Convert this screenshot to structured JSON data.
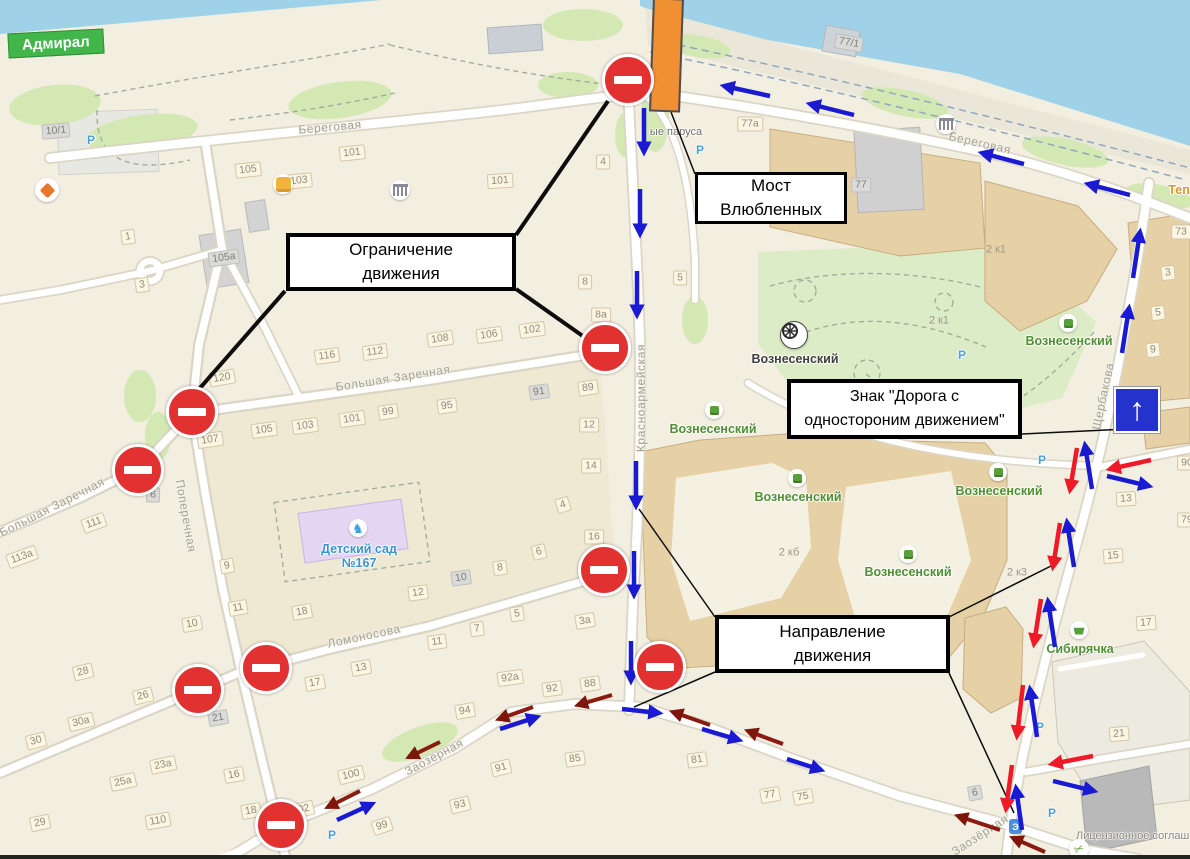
{
  "app": {
    "type": "map-annotation-screenshot"
  },
  "admiral": {
    "label": "Адмирал"
  },
  "license": {
    "text": "Лицензионное соглашение"
  },
  "callouts": {
    "most": {
      "line1": "Мост",
      "line2": "Влюбленных"
    },
    "ogranichenie": {
      "line1": "Ограничение",
      "line2": "движения"
    },
    "znak": {
      "line1": "Знак \"Дорога с",
      "line2": "одностороним движением\""
    },
    "napravlenie": {
      "line1": "Направление",
      "line2": "движения"
    }
  },
  "streets": [
    [
      "Береговая",
      330,
      127,
      -5
    ],
    [
      "Береговая",
      980,
      143,
      13
    ],
    [
      "Красноармейская",
      641,
      398,
      -90
    ],
    [
      "Щербакова",
      1103,
      396,
      -78
    ],
    [
      "Большая Заречная",
      52,
      507,
      -27
    ],
    [
      "Большая Заречная",
      393,
      378,
      -9
    ],
    [
      "Поперечная",
      186,
      516,
      80
    ],
    [
      "Ломоносова",
      364,
      636,
      -12
    ],
    [
      "Заозёрная",
      434,
      757,
      -28
    ],
    [
      "Заозёрная",
      980,
      835,
      -33
    ]
  ],
  "houses": [
    [
      "105",
      248,
      170,
      -6,
      ""
    ],
    [
      "103",
      299,
      181,
      -6,
      ""
    ],
    [
      "101",
      352,
      153,
      -6,
      ""
    ],
    [
      "101",
      500,
      181,
      -4,
      ""
    ],
    [
      "10/1",
      56,
      131,
      -5,
      "g"
    ],
    [
      "1",
      128,
      237,
      -8,
      ""
    ],
    [
      "105а",
      224,
      258,
      -8,
      "g"
    ],
    [
      "3",
      142,
      285,
      -8,
      ""
    ],
    [
      "120",
      222,
      378,
      -10,
      ""
    ],
    [
      "116",
      327,
      356,
      -8,
      ""
    ],
    [
      "112",
      375,
      352,
      -8,
      ""
    ],
    [
      "108",
      440,
      339,
      -8,
      ""
    ],
    [
      "106",
      489,
      335,
      -8,
      ""
    ],
    [
      "102",
      532,
      330,
      -8,
      ""
    ],
    [
      "8а",
      601,
      315,
      0,
      ""
    ],
    [
      "8",
      585,
      282,
      0,
      ""
    ],
    [
      "4",
      603,
      162,
      0,
      ""
    ],
    [
      "5",
      680,
      278,
      0,
      ""
    ],
    [
      "89",
      588,
      388,
      -8,
      ""
    ],
    [
      "91",
      539,
      392,
      -8,
      "g"
    ],
    [
      "12",
      589,
      425,
      0,
      ""
    ],
    [
      "14",
      591,
      466,
      0,
      ""
    ],
    [
      "4",
      563,
      505,
      -18,
      ""
    ],
    [
      "16",
      594,
      537,
      0,
      ""
    ],
    [
      "6",
      539,
      552,
      -14,
      ""
    ],
    [
      "3а",
      585,
      621,
      -10,
      ""
    ],
    [
      "107",
      210,
      440,
      -8,
      ""
    ],
    [
      "105",
      264,
      430,
      -8,
      ""
    ],
    [
      "103",
      305,
      426,
      -8,
      ""
    ],
    [
      "101",
      352,
      419,
      -8,
      ""
    ],
    [
      "99",
      388,
      412,
      -8,
      ""
    ],
    [
      "95",
      447,
      406,
      -8,
      ""
    ],
    [
      "113а",
      22,
      557,
      -20,
      ""
    ],
    [
      "111",
      94,
      523,
      -20,
      ""
    ],
    [
      "6",
      153,
      495,
      0,
      "g"
    ],
    [
      "9",
      227,
      566,
      -10,
      ""
    ],
    [
      "11",
      238,
      608,
      -10,
      ""
    ],
    [
      "10",
      192,
      624,
      -10,
      ""
    ],
    [
      "18",
      302,
      612,
      -10,
      ""
    ],
    [
      "12",
      418,
      593,
      -8,
      ""
    ],
    [
      "10",
      461,
      578,
      -8,
      "g"
    ],
    [
      "8",
      500,
      568,
      -8,
      ""
    ],
    [
      "7",
      477,
      629,
      -8,
      ""
    ],
    [
      "5",
      517,
      614,
      -8,
      ""
    ],
    [
      "11",
      437,
      642,
      -8,
      ""
    ],
    [
      "13",
      361,
      668,
      -10,
      ""
    ],
    [
      "17",
      315,
      683,
      -10,
      ""
    ],
    [
      "21",
      218,
      718,
      -10,
      "g"
    ],
    [
      "28",
      83,
      672,
      -14,
      ""
    ],
    [
      "26",
      143,
      696,
      -14,
      ""
    ],
    [
      "30а",
      81,
      722,
      -14,
      ""
    ],
    [
      "30",
      36,
      741,
      -14,
      ""
    ],
    [
      "25а",
      123,
      782,
      -12,
      ""
    ],
    [
      "23а",
      163,
      765,
      -12,
      ""
    ],
    [
      "29",
      40,
      823,
      -12,
      ""
    ],
    [
      "110",
      158,
      821,
      -10,
      ""
    ],
    [
      "16",
      234,
      775,
      -10,
      ""
    ],
    [
      "18",
      251,
      811,
      -10,
      ""
    ],
    [
      "100",
      351,
      775,
      -14,
      ""
    ],
    [
      "102",
      301,
      810,
      -14,
      ""
    ],
    [
      "99",
      382,
      826,
      -18,
      ""
    ],
    [
      "93",
      460,
      805,
      -14,
      ""
    ],
    [
      "91",
      501,
      768,
      -14,
      ""
    ],
    [
      "92а",
      510,
      678,
      -8,
      ""
    ],
    [
      "92",
      552,
      689,
      -8,
      ""
    ],
    [
      "88",
      590,
      684,
      -8,
      ""
    ],
    [
      "94",
      465,
      711,
      -10,
      ""
    ],
    [
      "85",
      575,
      759,
      -8,
      ""
    ],
    [
      "81",
      697,
      760,
      -8,
      ""
    ],
    [
      "77",
      770,
      795,
      -10,
      ""
    ],
    [
      "75",
      803,
      797,
      -10,
      ""
    ],
    [
      "77/1",
      849,
      43,
      10,
      "g"
    ],
    [
      "77а",
      750,
      124,
      0,
      ""
    ],
    [
      "77",
      861,
      185,
      0,
      "g"
    ],
    [
      "2 к1",
      996,
      250,
      0,
      "p"
    ],
    [
      "2 к1",
      939,
      321,
      0,
      "p"
    ],
    [
      "2 кб",
      789,
      553,
      0,
      "p"
    ],
    [
      "2 к3",
      1017,
      573,
      0,
      "p"
    ],
    [
      "73",
      1181,
      232,
      0,
      ""
    ],
    [
      "3",
      1168,
      273,
      -6,
      ""
    ],
    [
      "5",
      1158,
      313,
      -6,
      ""
    ],
    [
      "9",
      1153,
      350,
      -6,
      ""
    ],
    [
      "90",
      1187,
      463,
      0,
      ""
    ],
    [
      "79",
      1187,
      520,
      0,
      ""
    ],
    [
      "13",
      1126,
      499,
      -4,
      ""
    ],
    [
      "15",
      1113,
      556,
      -4,
      ""
    ],
    [
      "17",
      1146,
      623,
      -4,
      ""
    ],
    [
      "21",
      1119,
      734,
      -5,
      ""
    ],
    [
      "6",
      975,
      793,
      -10,
      "g"
    ]
  ],
  "places": [
    {
      "t": "Вознесенский",
      "c": "dark",
      "x": 795,
      "y": 359,
      "icon": "church",
      "ix": 793,
      "iy": 334
    },
    {
      "t": "Вознесенский",
      "c": "green",
      "x": 713,
      "y": 429,
      "icon": "bld",
      "ix": 714,
      "iy": 410
    },
    {
      "t": "Вознесенский",
      "c": "green",
      "x": 798,
      "y": 497,
      "icon": "bld",
      "ix": 797,
      "iy": 478
    },
    {
      "t": "Вознесенский",
      "c": "green",
      "x": 908,
      "y": 572,
      "icon": "bld",
      "ix": 908,
      "iy": 554
    },
    {
      "t": "Вознесенский",
      "c": "green",
      "x": 999,
      "y": 491,
      "icon": "bld",
      "ix": 998,
      "iy": 472
    },
    {
      "t": "Вознесенский",
      "c": "green",
      "x": 1069,
      "y": 341,
      "icon": "bld",
      "ix": 1068,
      "iy": 323
    },
    {
      "t": "Сибирячка",
      "c": "green",
      "x": 1080,
      "y": 649,
      "icon": "basket",
      "ix": 1079,
      "iy": 630
    },
    {
      "t": "Детский сад",
      "c": "blue",
      "x": 359,
      "y": 549,
      "icon": "horse",
      "ix": 358,
      "iy": 528
    },
    {
      "t": "№167",
      "c": "blue",
      "x": 359,
      "y": 563
    },
    {
      "t": "ые паруса",
      "c": "grey",
      "x": 676,
      "y": 132
    },
    {
      "t": "Тепл",
      "c": "orange",
      "x": 1183,
      "y": 190
    }
  ],
  "parking": {
    "label": "Р",
    "positions": [
      [
        91,
        140
      ],
      [
        700,
        150
      ],
      [
        962,
        355
      ],
      [
        1042,
        460
      ],
      [
        1040,
        727
      ],
      [
        1052,
        813
      ],
      [
        332,
        835
      ]
    ]
  },
  "map_icons": [
    {
      "type": "diamond",
      "x": 47,
      "y": 190
    },
    {
      "type": "shop",
      "x": 283,
      "y": 184
    },
    {
      "type": "museum",
      "x": 400,
      "y": 190
    },
    {
      "type": "museum",
      "x": 946,
      "y": 124
    },
    {
      "type": "scissors",
      "x": 1079,
      "y": 849
    },
    {
      "type": "transport",
      "x": 1016,
      "y": 827
    }
  ],
  "signs": {
    "no_entry": [
      [
        628,
        80
      ],
      [
        605,
        348
      ],
      [
        192,
        412
      ],
      [
        138,
        470
      ],
      [
        604,
        570
      ],
      [
        660,
        667
      ],
      [
        266,
        668
      ],
      [
        198,
        690
      ],
      [
        281,
        825
      ]
    ],
    "one_way": {
      "x": 1114,
      "y": 387,
      "arrow": "↑"
    }
  },
  "bridge": {
    "color": "#f18f33"
  },
  "arrows": {
    "blue": [
      [
        644,
        108,
        644,
        152
      ],
      [
        640,
        189,
        640,
        234
      ],
      [
        637,
        271,
        637,
        315
      ],
      [
        636,
        461,
        636,
        506
      ],
      [
        634,
        551,
        634,
        595
      ],
      [
        631,
        641,
        631,
        681
      ],
      [
        770,
        96,
        724,
        86
      ],
      [
        854,
        115,
        810,
        104
      ],
      [
        1024,
        164,
        982,
        153
      ],
      [
        1130,
        195,
        1088,
        184
      ],
      [
        1133,
        278,
        1140,
        232
      ],
      [
        1122,
        353,
        1129,
        308
      ],
      [
        1092,
        489,
        1085,
        445
      ],
      [
        1074,
        567,
        1067,
        522
      ],
      [
        1055,
        647,
        1048,
        601
      ],
      [
        1037,
        737,
        1030,
        689
      ],
      [
        1022,
        830,
        1016,
        788
      ],
      [
        1107,
        476,
        1149,
        486
      ],
      [
        1053,
        781,
        1094,
        791
      ],
      [
        337,
        820,
        372,
        804
      ],
      [
        500,
        729,
        537,
        717
      ],
      [
        622,
        709,
        659,
        713
      ],
      [
        702,
        729,
        739,
        740
      ],
      [
        787,
        759,
        821,
        770
      ]
    ],
    "red": [
      [
        1077,
        448,
        1070,
        490
      ],
      [
        1060,
        523,
        1053,
        567
      ],
      [
        1041,
        599,
        1034,
        644
      ],
      [
        1023,
        685,
        1017,
        736
      ],
      [
        1012,
        765,
        1006,
        809
      ],
      [
        1151,
        460,
        1110,
        469
      ],
      [
        1093,
        756,
        1052,
        764
      ]
    ],
    "maroon": [
      [
        360,
        791,
        328,
        807
      ],
      [
        440,
        742,
        409,
        757
      ],
      [
        533,
        707,
        499,
        719
      ],
      [
        612,
        695,
        578,
        705
      ],
      [
        710,
        725,
        673,
        712
      ],
      [
        783,
        744,
        748,
        731
      ],
      [
        1000,
        830,
        958,
        816
      ],
      [
        1045,
        852,
        1013,
        838
      ]
    ]
  },
  "connectors": {
    "thick": [
      [
        285,
        291,
        200,
        388
      ],
      [
        516,
        289,
        587,
        339
      ],
      [
        516,
        235,
        608,
        101
      ]
    ],
    "thin": [
      [
        695,
        174,
        671,
        112
      ],
      [
        1022,
        434,
        1127,
        429
      ],
      [
        715,
        617,
        639,
        509
      ],
      [
        715,
        672,
        634,
        707
      ],
      [
        949,
        617,
        1057,
        563
      ],
      [
        949,
        673,
        1014,
        813
      ]
    ]
  },
  "colors": {
    "water": "#9fd2e8",
    "land": "#f2eee0",
    "no_entry_red": "#e23131",
    "arrow_blue": "#1a1ad2",
    "arrow_red": "#ee1a28",
    "arrow_maroon": "#8b1b10",
    "bridge_orange": "#f18f33",
    "one_way_blue": "#2433cc",
    "admiral_green": "#42b64a",
    "park_green": "#dcecc6",
    "building_tan": "#e6d1a6"
  }
}
